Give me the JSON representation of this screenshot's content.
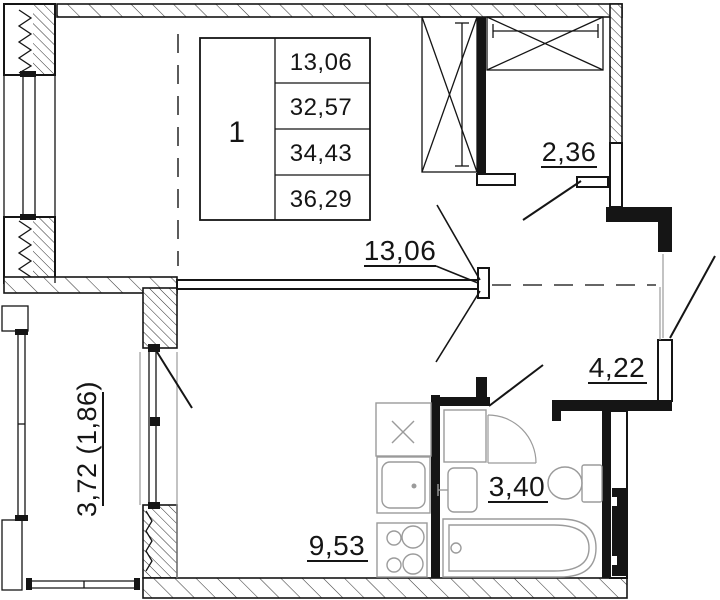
{
  "unit_table": {
    "unit_number": "1",
    "areas": [
      "13,06",
      "32,57",
      "34,43",
      "36,29"
    ]
  },
  "room_labels": {
    "living_room": "13,06",
    "loggia": "2,36",
    "hallway": "4,22",
    "bathroom": "3,40",
    "kitchen": "9,53",
    "balcony": "3,72 (1,86)"
  },
  "colors": {
    "line": "#151515",
    "fixture": "#9b9b9b",
    "background": "#ffffff"
  }
}
